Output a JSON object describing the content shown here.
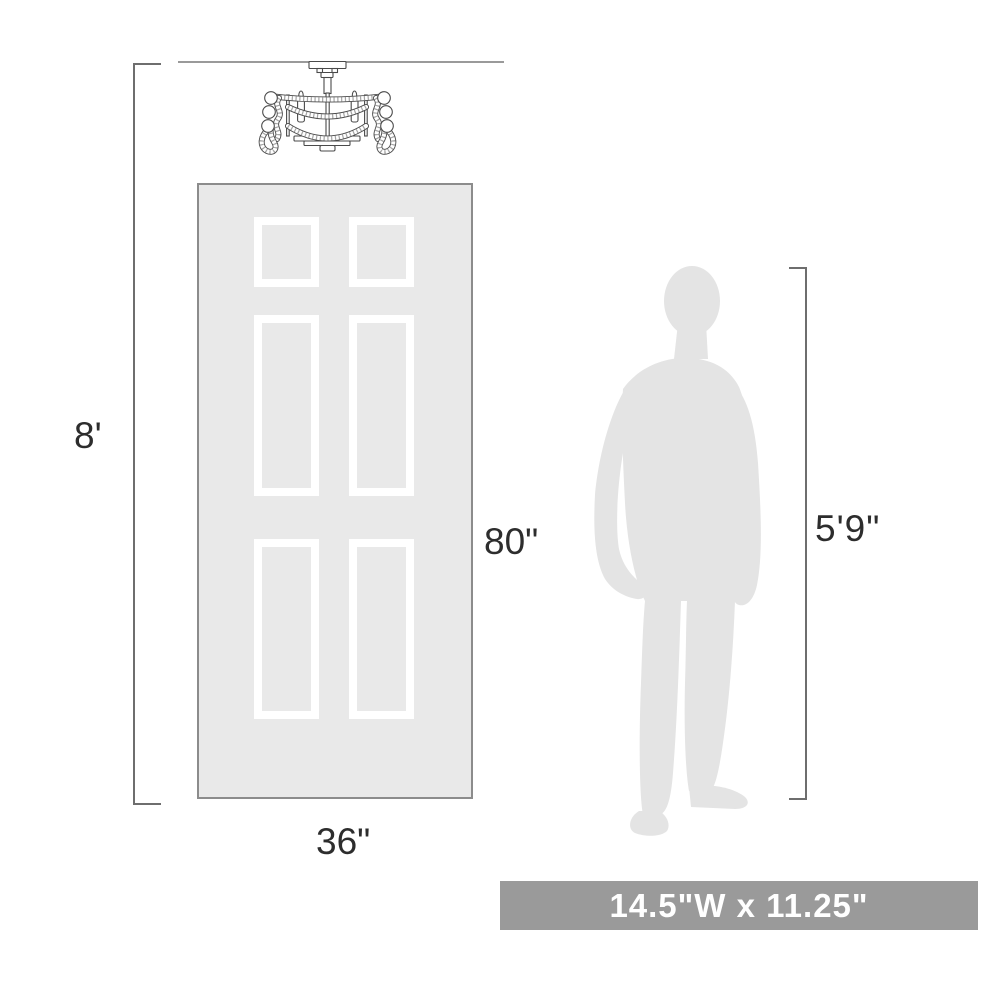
{
  "diagram": {
    "labels": {
      "ceiling_height": "8'",
      "door_height": "80\"",
      "door_width": "36\"",
      "person_height": "5'9\"",
      "fixture_size": "14.5\"W x 11.25\""
    },
    "colors": {
      "line": "#6e6e6e",
      "ceiling_line": "#9a9a9a",
      "text": "#2d2d2d",
      "door_fill": "#e9e9e9",
      "door_border": "#8c8c8c",
      "panel": "#ffffff",
      "silhouette": "#e4e4e4",
      "banner_bg": "#9a9a9a",
      "banner_text": "#ffffff",
      "fixture_line": "#4a4a4a"
    }
  }
}
